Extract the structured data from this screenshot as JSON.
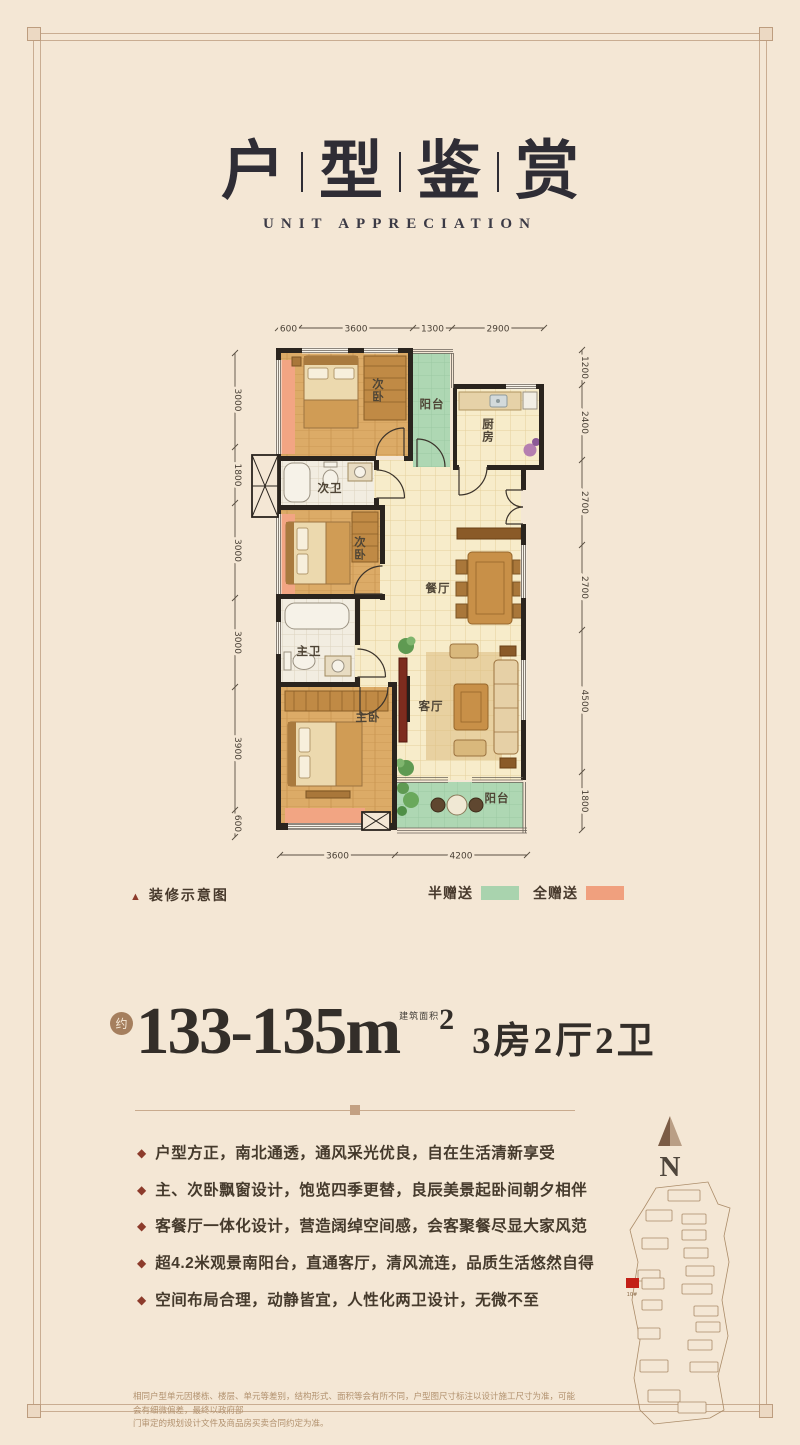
{
  "header": {
    "title_chars": [
      "户",
      "型",
      "鉴",
      "赏"
    ],
    "subtitle": "UNIT APPRECIATION"
  },
  "plan": {
    "caption_icon": "▲",
    "caption": "装修示意图",
    "legend": [
      {
        "label": "半赠送",
        "color": "#a9d3ae"
      },
      {
        "label": "全赠送",
        "color": "#f0a07e"
      }
    ],
    "rooms": {
      "bedroom_top": "次卧",
      "balcony_north": "阳台",
      "kitchen": "厨房",
      "bath_second": "次卫",
      "bedroom_mid": "次卧",
      "dining": "餐厅",
      "bath_master": "主卫",
      "bedroom_master": "主卧",
      "living": "客厅",
      "balcony_south": "阳台"
    },
    "dims_top": [
      "600",
      "3600",
      "1300",
      "2900"
    ],
    "dims_bottom": [
      "3600",
      "4200"
    ],
    "dims_left": [
      "3000",
      "1800",
      "3000",
      "3000",
      "3900",
      "600"
    ],
    "dims_right": [
      "1200",
      "2400",
      "2700",
      "2700",
      "4500",
      "1800"
    ]
  },
  "headline": {
    "approx_seal": "约",
    "area_range": "133-135",
    "unit": "m",
    "area_label": "建筑面积",
    "superscript": "2",
    "layout_text": "3房2厅2卫"
  },
  "features": {
    "bullet_icon": "◆",
    "items": [
      "户型方正，南北通透，通风采光优良，自在生活清新享受",
      "主、次卧飘窗设计，饱览四季更替，良辰美景起卧间朝夕相伴",
      "客餐厅一体化设计，营造阔绰空间感，会客聚餐尽显大家风范",
      "超4.2米观景南阳台，直通客厅，清风流连，品质生活悠然自得",
      "空间布局合理，动静皆宜，人性化两卫设计，无微不至"
    ]
  },
  "compass": {
    "label": "N"
  },
  "sitemap": {
    "highlight_label": "10#",
    "highlight_color": "#c32017"
  },
  "footer": {
    "line1": "相同户型单元因楼栋、楼层、单元等差别，结构形式、面积等会有所不同，户型图尺寸标注以设计施工尺寸为准，可能会有细微偏差，最终以政府部",
    "line2": "门审定的规划设计文件及商品房买卖合同约定为准。"
  }
}
